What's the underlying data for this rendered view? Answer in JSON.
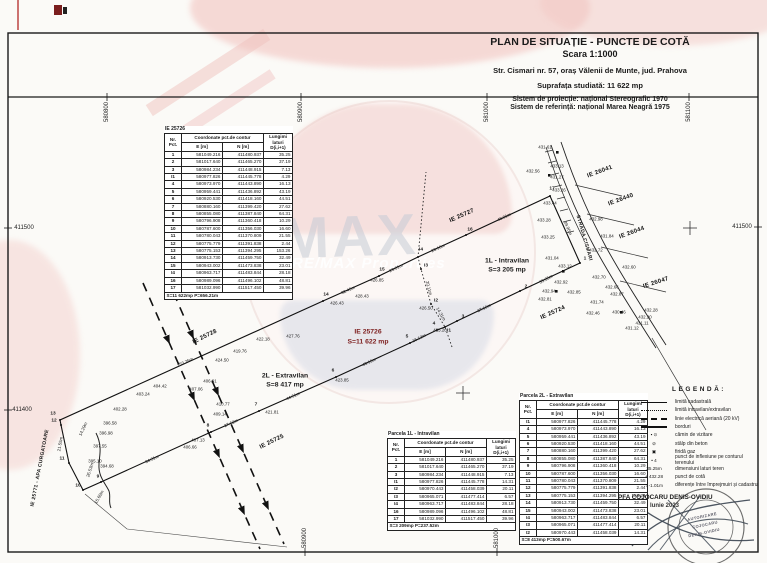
{
  "title_block": {
    "line1": "PLAN DE SITUAȚIE - PUNCTE DE COTĂ",
    "line2": "Scara 1:1000",
    "line3": "Str. Cismari nr. 57, oraș Vălenii de Munte, jud. Prahova",
    "line4": "Suprafața studiată: 11 622 mp",
    "line5": "Sistem de proiecție: național Stereografic 1970",
    "line6": "Sistem de referință: național Marea Neagră 1975"
  },
  "watermark": {
    "text": "RE/MAX",
    "subtext": "RE/MAX Properties"
  },
  "tables": {
    "header": {
      "nr": "Nr. Pct.",
      "coord": "Coordonate pct.de contur",
      "e": "E [m]",
      "n": "N [m]",
      "lung": "Lungimi laturi D(i,i+1)"
    },
    "main": {
      "title": "IE 25726",
      "rows": [
        [
          "1",
          "581049.216",
          "411480.937",
          "35.25"
        ],
        [
          "2",
          "581017.640",
          "411465.270",
          "37.19"
        ],
        [
          "3",
          "580984.234",
          "411448.915",
          "7.13"
        ],
        [
          "I1",
          "580977.826",
          "411445.778",
          "4.29"
        ],
        [
          "4",
          "580973.970",
          "411443.890",
          "16.13"
        ],
        [
          "5",
          "580959.441",
          "411436.892",
          "43.19"
        ],
        [
          "6",
          "580920.530",
          "411418.160",
          "44.51"
        ],
        [
          "7",
          "580880.160",
          "411399.420",
          "27.62"
        ],
        [
          "8",
          "580855.080",
          "411387.840",
          "64.31"
        ],
        [
          "9",
          "580796.908",
          "411360.418",
          "10.29"
        ],
        [
          "10",
          "580787.600",
          "411356.030",
          "16.60"
        ],
        [
          "11",
          "580780.043",
          "411370.809",
          "21.55"
        ],
        [
          "12",
          "580775.779",
          "411391.838",
          "2.44"
        ],
        [
          "13",
          "580775.153",
          "411394.295",
          "153.26"
        ],
        [
          "14",
          "580913.730",
          "411459.750",
          "32.49"
        ],
        [
          "15",
          "580943.002",
          "411473.838",
          "23.01"
        ],
        [
          "I4",
          "580963.717",
          "411483.844",
          "28.18"
        ],
        [
          "16",
          "580989.096",
          "411496.102",
          "48.81"
        ],
        [
          "17",
          "581032.990",
          "411517.450",
          "39.96"
        ]
      ],
      "footer": "S=11 622mp  P=656.21m"
    },
    "parcel1l": {
      "title": "Parcela 1L - Intravilan",
      "rows": [
        [
          "1",
          "581049.216",
          "411480.937",
          "35.25"
        ],
        [
          "2",
          "581017.640",
          "411465.270",
          "37.19"
        ],
        [
          "3",
          "580984.234",
          "411448.915",
          "7.13"
        ],
        [
          "I1",
          "580977.826",
          "411445.778",
          "14.31"
        ],
        [
          "I2",
          "580970.443",
          "411458.039",
          "20.11"
        ],
        [
          "I3",
          "580965.071",
          "411477.414",
          "6.57"
        ],
        [
          "I4",
          "580963.717",
          "411483.844",
          "28.18"
        ],
        [
          "16",
          "580989.096",
          "411496.102",
          "48.81"
        ],
        [
          "17",
          "581032.990",
          "411517.450",
          "39.96"
        ]
      ],
      "footer": "S=3 209mp  P=237.52m"
    },
    "parcel2l": {
      "title": "Parcela 2L - Extravilan",
      "rows": [
        [
          "I1",
          "580977.826",
          "411445.778",
          "4.29"
        ],
        [
          "4",
          "580973.970",
          "411443.890",
          "16.13"
        ],
        [
          "5",
          "580959.441",
          "411436.892",
          "43.19"
        ],
        [
          "6",
          "580920.530",
          "411418.160",
          "44.51"
        ],
        [
          "7",
          "580880.160",
          "411399.420",
          "27.62"
        ],
        [
          "8",
          "580855.080",
          "411387.840",
          "64.31"
        ],
        [
          "9",
          "580796.908",
          "411360.418",
          "10.29"
        ],
        [
          "10",
          "580787.600",
          "411356.030",
          "16.60"
        ],
        [
          "11",
          "580780.043",
          "411370.809",
          "21.55"
        ],
        [
          "12",
          "580775.779",
          "411391.838",
          "2.44"
        ],
        [
          "13",
          "580775.153",
          "411394.295",
          "153.26"
        ],
        [
          "14",
          "580913.730",
          "411459.750",
          "32.49"
        ],
        [
          "15",
          "580943.002",
          "411473.838",
          "23.01"
        ],
        [
          "I4",
          "580963.717",
          "411483.844",
          "6.57"
        ],
        [
          "I3",
          "580965.071",
          "411477.414",
          "20.11"
        ],
        [
          "I2",
          "580970.443",
          "411458.039",
          "14.31"
        ]
      ],
      "footer": "S=8 413mp  P=500.67m"
    }
  },
  "legend": {
    "title": "LEGENDĂ:",
    "items": [
      {
        "type": "solid",
        "label": "limită cadastrală"
      },
      {
        "type": "dotted",
        "label": "limită intravilan/extravilan"
      },
      {
        "type": "dash",
        "label": "linie electrică aeriană (20 kV)"
      },
      {
        "type": "thick",
        "label": "borduri"
      },
      {
        "type": "text",
        "sym": "▪ ⊙",
        "label": "cămin de vizitare"
      },
      {
        "type": "text",
        "sym": "⊘",
        "label": "stâlp din beton"
      },
      {
        "type": "text",
        "sym": "▣",
        "label": "firidă gaz"
      },
      {
        "type": "text",
        "sym": "• 4",
        "label": "punct de inflexiune pe conturul terenului"
      },
      {
        "type": "text",
        "sym": "35.25m",
        "label": "dimensiuni laturi teren"
      },
      {
        "type": "text",
        "sym": "+ 432.28",
        "label": "punct de cotă"
      },
      {
        "type": "text",
        "sym": "↕ -1.01m",
        "label": "diferențe între împrejmuiri și cadastru"
      }
    ]
  },
  "signature": {
    "name": "PFA COJOCARU DENIS-OVIDIU",
    "date": "Iunie 2023",
    "stamp_line1": "AUTORIZARE",
    "stamp_line2": "COJOCARU",
    "stamp_line3": "DENIS-OVIDIU"
  },
  "grid_labels": [
    {
      "t": "580800",
      "x": 107,
      "y": 112,
      "r": -90
    },
    {
      "t": "580900",
      "x": 301,
      "y": 112,
      "r": -90
    },
    {
      "t": "581000",
      "x": 487,
      "y": 112,
      "r": -90
    },
    {
      "t": "581100",
      "x": 689,
      "y": 112,
      "r": -90
    },
    {
      "t": "580900",
      "x": 305,
      "y": 538,
      "r": -90
    },
    {
      "t": "581000",
      "x": 497,
      "y": 538,
      "r": -90
    },
    {
      "t": "411500",
      "x": 24,
      "y": 228
    },
    {
      "t": "411400",
      "x": 22,
      "y": 410
    },
    {
      "t": "411500",
      "x": 742,
      "y": 227
    }
  ],
  "area_labels": [
    {
      "t": "IE 25726",
      "x": 368,
      "y": 332,
      "c": "#7c1d1d"
    },
    {
      "t": "S=11 622 mp",
      "x": 368,
      "y": 342,
      "c": "#7c1d1d"
    },
    {
      "t": "1L - Intravilan",
      "x": 507,
      "y": 261
    },
    {
      "t": "S=3 205 mp",
      "x": 507,
      "y": 270
    },
    {
      "t": "2L - Extravilan",
      "x": 285,
      "y": 376
    },
    {
      "t": "S=8 417 mp",
      "x": 285,
      "y": 385
    }
  ],
  "name_labels": [
    {
      "t": "IE 25727",
      "x": 462,
      "y": 216,
      "r": -24
    },
    {
      "t": "IE 25728",
      "x": 205,
      "y": 337,
      "r": -26
    },
    {
      "t": "IE 25725",
      "x": 272,
      "y": 442,
      "r": -26
    },
    {
      "t": "IE 25724",
      "x": 553,
      "y": 313,
      "r": -24
    },
    {
      "t": "IE 26041",
      "x": 600,
      "y": 172,
      "r": -20
    },
    {
      "t": "IE 26440",
      "x": 621,
      "y": 200,
      "r": -20
    },
    {
      "t": "IE 26044",
      "x": 632,
      "y": 233,
      "r": -20
    },
    {
      "t": "IE 26047",
      "x": 656,
      "y": 283,
      "r": -18
    },
    {
      "t": "STRADA CISMARI",
      "x": 584,
      "y": 238,
      "r": 74,
      "fs": 5
    },
    {
      "t": "IE 25771 - APA CURGATOARE",
      "x": 40,
      "y": 468,
      "r": -79,
      "fs": 5
    }
  ],
  "point_labels": [
    {
      "t": "1",
      "x": 585,
      "y": 259
    },
    {
      "t": "2",
      "x": 526,
      "y": 287
    },
    {
      "t": "3",
      "x": 463,
      "y": 317
    },
    {
      "t": "4",
      "x": 434,
      "y": 324
    },
    {
      "t": "5",
      "x": 407,
      "y": 337
    },
    {
      "t": "6",
      "x": 333,
      "y": 371
    },
    {
      "t": "7",
      "x": 256,
      "y": 405
    },
    {
      "t": "8",
      "x": 208,
      "y": 426
    },
    {
      "t": "9",
      "x": 98,
      "y": 477
    },
    {
      "t": "10",
      "x": 78,
      "y": 486
    },
    {
      "t": "11",
      "x": 62,
      "y": 459
    },
    {
      "t": "12",
      "x": 54,
      "y": 421
    },
    {
      "t": "13",
      "x": 53,
      "y": 414
    },
    {
      "t": "14",
      "x": 326,
      "y": 295
    },
    {
      "t": "15",
      "x": 382,
      "y": 270
    },
    {
      "t": "16",
      "x": 470,
      "y": 230
    },
    {
      "t": "17",
      "x": 552,
      "y": 189
    },
    {
      "t": "I1",
      "x": 449,
      "y": 331
    },
    {
      "t": "I2",
      "x": 436,
      "y": 301
    },
    {
      "t": "I3",
      "x": 426,
      "y": 266
    },
    {
      "t": "I4",
      "x": 421,
      "y": 250
    }
  ],
  "dim_labels": [
    {
      "t": "35.25m",
      "x": 546,
      "y": 279,
      "r": -28
    },
    {
      "t": "37.19m",
      "x": 484,
      "y": 308,
      "r": -26
    },
    {
      "t": "16.13m",
      "x": 419,
      "y": 338,
      "r": -26
    },
    {
      "t": "43.19m",
      "x": 369,
      "y": 362,
      "r": -25
    },
    {
      "t": "44.51m",
      "x": 293,
      "y": 396,
      "r": -24
    },
    {
      "t": "27.62m",
      "x": 231,
      "y": 423,
      "r": -24
    },
    {
      "t": "64.31m",
      "x": 152,
      "y": 459,
      "r": -25
    },
    {
      "t": "153.26m",
      "x": 185,
      "y": 362,
      "r": -24
    },
    {
      "t": "32.49m",
      "x": 348,
      "y": 290,
      "r": -24
    },
    {
      "t": "23.01m",
      "x": 396,
      "y": 268,
      "r": -25
    },
    {
      "t": "28.18m",
      "x": 438,
      "y": 248,
      "r": -25
    },
    {
      "t": "48.81m",
      "x": 504,
      "y": 217,
      "r": -25
    },
    {
      "t": "39.96m",
      "x": 568,
      "y": 228,
      "r": 66
    },
    {
      "t": "20.11m",
      "x": 429,
      "y": 288,
      "r": 75
    },
    {
      "t": "14.31m",
      "x": 441,
      "y": 314,
      "r": 60
    },
    {
      "t": "14.29m",
      "x": 83,
      "y": 429,
      "r": -65
    },
    {
      "t": "26.53m",
      "x": 90,
      "y": 470,
      "r": -72
    },
    {
      "t": "15.60m",
      "x": 99,
      "y": 497,
      "r": -60
    },
    {
      "t": "21.55m",
      "x": 60,
      "y": 444,
      "r": -80
    }
  ],
  "elev_labels": [
    {
      "t": "431.61",
      "x": 545,
      "y": 147
    },
    {
      "t": "432.56",
      "x": 533,
      "y": 171
    },
    {
      "t": "433.13",
      "x": 557,
      "y": 166
    },
    {
      "t": "431.27",
      "x": 557,
      "y": 177
    },
    {
      "t": "433.26",
      "x": 559,
      "y": 190
    },
    {
      "t": "433.44",
      "x": 550,
      "y": 203
    },
    {
      "t": "433.28",
      "x": 544,
      "y": 220
    },
    {
      "t": "433.25",
      "x": 548,
      "y": 237
    },
    {
      "t": "431.04",
      "x": 552,
      "y": 258
    },
    {
      "t": "433.12",
      "x": 565,
      "y": 266
    },
    {
      "t": "432.92",
      "x": 561,
      "y": 282
    },
    {
      "t": "432.94",
      "x": 549,
      "y": 291
    },
    {
      "t": "432.85",
      "x": 574,
      "y": 292
    },
    {
      "t": "432.81",
      "x": 545,
      "y": 299
    },
    {
      "t": "432.72",
      "x": 596,
      "y": 250
    },
    {
      "t": "432.70",
      "x": 599,
      "y": 277
    },
    {
      "t": "432.98",
      "x": 596,
      "y": 219
    },
    {
      "t": "431.84",
      "x": 607,
      "y": 236
    },
    {
      "t": "432.60",
      "x": 629,
      "y": 267
    },
    {
      "t": "432.66",
      "x": 612,
      "y": 287
    },
    {
      "t": "432.87",
      "x": 617,
      "y": 294
    },
    {
      "t": "431.74",
      "x": 597,
      "y": 302
    },
    {
      "t": "432.46",
      "x": 593,
      "y": 313
    },
    {
      "t": "430.46",
      "x": 619,
      "y": 312
    },
    {
      "t": "432.28",
      "x": 651,
      "y": 310
    },
    {
      "t": "432.20",
      "x": 645,
      "y": 317
    },
    {
      "t": "431.11",
      "x": 642,
      "y": 323
    },
    {
      "t": "431.12",
      "x": 632,
      "y": 328
    },
    {
      "t": "426.85",
      "x": 377,
      "y": 280
    },
    {
      "t": "426.43",
      "x": 337,
      "y": 303
    },
    {
      "t": "427.76",
      "x": 293,
      "y": 336
    },
    {
      "t": "428.43",
      "x": 362,
      "y": 296
    },
    {
      "t": "426.50",
      "x": 426,
      "y": 308
    },
    {
      "t": "425.20",
      "x": 440,
      "y": 330
    },
    {
      "t": "423.85",
      "x": 342,
      "y": 380
    },
    {
      "t": "421.81",
      "x": 272,
      "y": 412
    },
    {
      "t": "422.18",
      "x": 263,
      "y": 339
    },
    {
      "t": "419.76",
      "x": 240,
      "y": 351
    },
    {
      "t": "424.50",
      "x": 222,
      "y": 360
    },
    {
      "t": "404.42",
      "x": 160,
      "y": 386
    },
    {
      "t": "403.24",
      "x": 143,
      "y": 394
    },
    {
      "t": "407.06",
      "x": 196,
      "y": 389
    },
    {
      "t": "406.91",
      "x": 210,
      "y": 381
    },
    {
      "t": "410.77",
      "x": 223,
      "y": 404
    },
    {
      "t": "409.14",
      "x": 220,
      "y": 414
    },
    {
      "t": "407.13",
      "x": 198,
      "y": 440
    },
    {
      "t": "406.66",
      "x": 190,
      "y": 447
    },
    {
      "t": "402.28",
      "x": 120,
      "y": 409
    },
    {
      "t": "396.58",
      "x": 110,
      "y": 423
    },
    {
      "t": "396.98",
      "x": 106,
      "y": 433
    },
    {
      "t": "397.55",
      "x": 100,
      "y": 446
    },
    {
      "t": "395.10",
      "x": 95,
      "y": 461
    },
    {
      "t": "394.68",
      "x": 107,
      "y": 466
    }
  ]
}
